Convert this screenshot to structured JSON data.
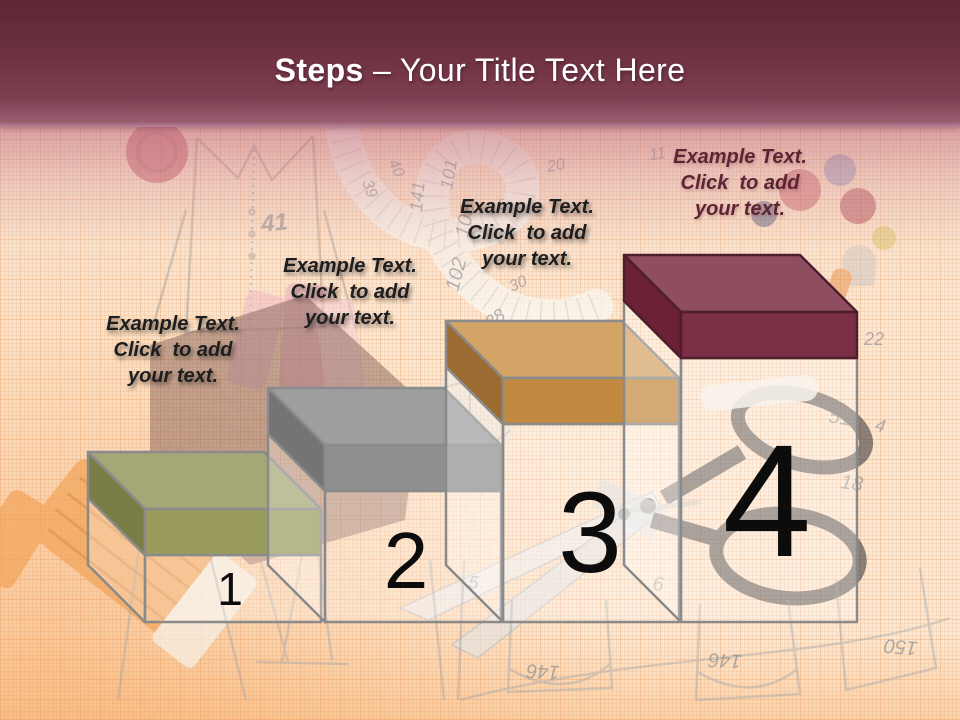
{
  "slide": {
    "title": {
      "bold": "Steps",
      "rest": " – Your Title Text Here"
    },
    "theme": {
      "title_color": "#ffffff",
      "header_top": "#5d2734",
      "header_bottom": "#9a5d70",
      "paper_color": "#fbe8d4",
      "number_color": "#0c0c0c"
    }
  },
  "steps": [
    {
      "number": "1",
      "label_lines": [
        "Example Text.",
        "Click  to add",
        "your text."
      ],
      "label_color": "#1e1e1e",
      "colors": {
        "top": "#a5a777",
        "front": "#9a9c5d",
        "side": "#7b7d46",
        "stroke": "#8b8b8b"
      }
    },
    {
      "number": "2",
      "label_lines": [
        "Example Text.",
        "Click  to add",
        "your text."
      ],
      "label_color": "#1e1e1e",
      "colors": {
        "top": "#9e9e9e",
        "front": "#8f8f8f",
        "side": "#747474",
        "stroke": "#8b8b8b"
      }
    },
    {
      "number": "3",
      "label_lines": [
        "Example Text.",
        "Click  to add",
        "your text."
      ],
      "label_color": "#1e1e1e",
      "colors": {
        "top": "#d3a466",
        "front": "#c28941",
        "side": "#9b6b31",
        "stroke": "#8b8b8b"
      }
    },
    {
      "number": "4",
      "label_lines": [
        "Example Text.",
        "Click  to add",
        "your text."
      ],
      "label_color": "#5e2433",
      "colors": {
        "top": "#8f4d60",
        "front": "#7c2e44",
        "side": "#6b2036",
        "stroke": "#4d1e2d"
      }
    }
  ],
  "background": {
    "numbers": [
      "41",
      "103",
      "102",
      "101",
      "141",
      "138",
      "30",
      "20",
      "39",
      "40",
      "5",
      "51",
      "4",
      "18",
      "6",
      "22",
      "146",
      "146",
      "150",
      "11",
      "5"
    ]
  }
}
